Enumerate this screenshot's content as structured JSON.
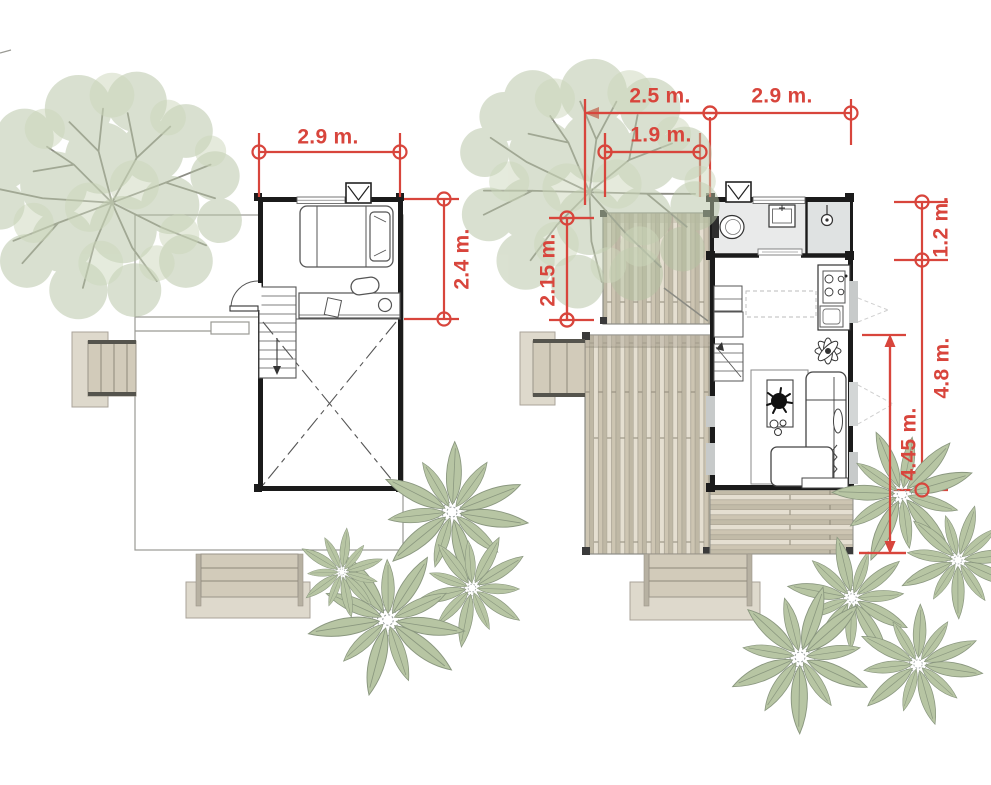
{
  "colors": {
    "dimension_red": "#d8453c",
    "wall_black": "#1b1b1b",
    "deck_beige": "#d3ccbc",
    "foliage_green": "#b5c3a3",
    "bath_floor": "#e9eaea"
  },
  "left_plan": {
    "dimensions": {
      "width": "2.9 m.",
      "depth": "2.4 m."
    }
  },
  "right_plan": {
    "dimensions": {
      "deck_width": "2.5 m.",
      "unit_width": "2.9 m.",
      "inner_width": "1.9 m.",
      "side_deck_depth": "2.15 m.",
      "bathroom_depth": "1.2 m.",
      "living_depth": "4.8 m.",
      "total_depth": "4.45 m."
    }
  }
}
